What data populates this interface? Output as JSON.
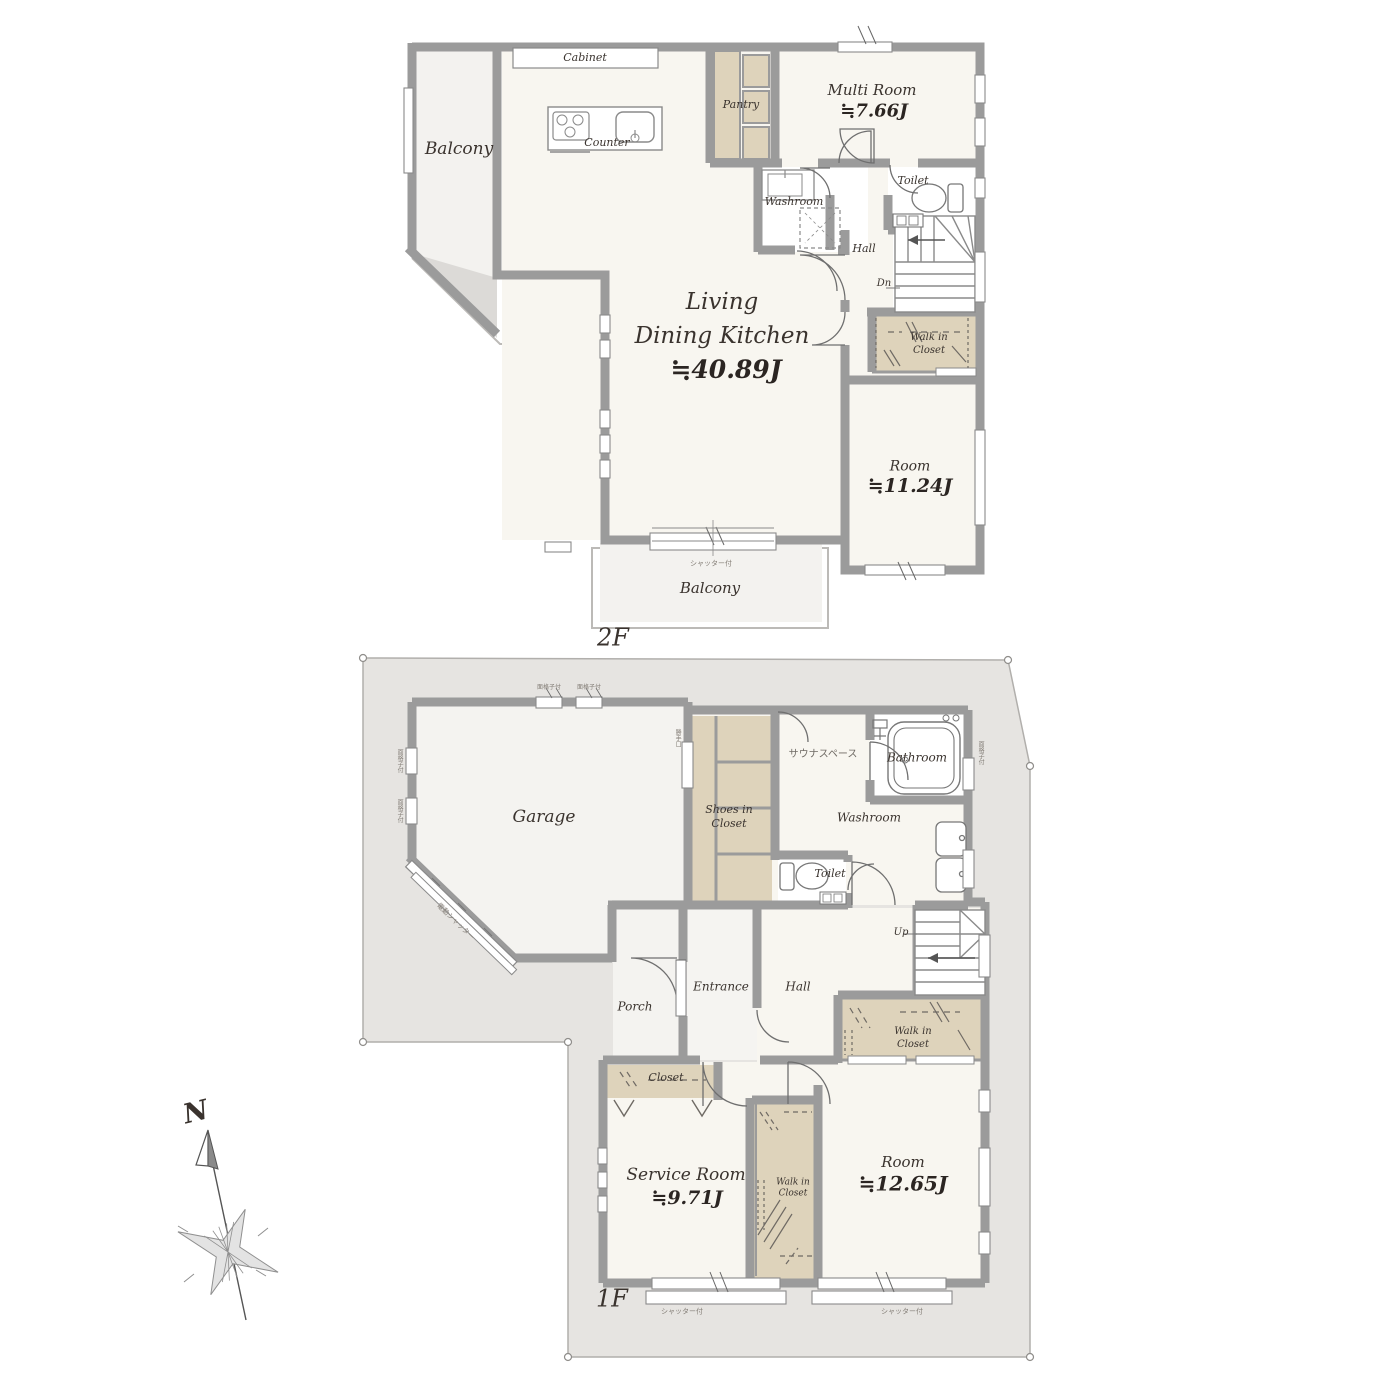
{
  "colors": {
    "wall": "#9b9b9b",
    "room_cream": "#f8f6f0",
    "outdoor": "#f3f2ef",
    "closet_tan": "#ded3bb",
    "lot": "#e6e4e1",
    "text": "#3a332e"
  },
  "floor2": {
    "floor_label": "2F",
    "balcony_top": "Balcony",
    "cabinet": "Cabinet",
    "counter": "Counter",
    "pantry": "Pantry",
    "multi_room": {
      "name": "Multi Room",
      "area": "≒7.66J"
    },
    "washroom": "Washroom",
    "toilet": "Toilet",
    "hall": "Hall",
    "stairs_dn": "Dn",
    "walk_in_closet": {
      "line1": "Walk in",
      "line2": "Closet"
    },
    "ldk": {
      "line1": "Living",
      "line2": "Dining Kitchen",
      "area": "≒40.89J"
    },
    "room": {
      "name": "Room",
      "area": "≒11.24J"
    },
    "balcony_bottom": "Balcony",
    "shutter_note": "シャッター付"
  },
  "floor1": {
    "floor_label": "1F",
    "garage": "Garage",
    "garage_shutter_note": "電動シャッター",
    "grille_note_top1": "面格子付",
    "grille_note_top2": "面格子付",
    "grille_note_left1": "面格子付",
    "grille_note_left2": "面格子付",
    "back_door_note": "勝手口",
    "bath_window_note": "面格子付",
    "shoes_closet": {
      "line1": "Shoes in",
      "line2": "Closet"
    },
    "sauna": "サウナスペース",
    "bathroom": "Bathroom",
    "washroom": "Washroom",
    "toilet": "Toilet",
    "stairs_up": "Up",
    "hall": "Hall",
    "entrance": "Entrance",
    "porch": "Porch",
    "closet": "Closet",
    "walk_in_closet_right": {
      "line1": "Walk in",
      "line2": "Closet"
    },
    "service_room": {
      "name": "Service Room",
      "area": "≒9.71J"
    },
    "walk_in_closet_mid": {
      "line1": "Walk in",
      "line2": "Closet"
    },
    "room": {
      "name": "Room",
      "area": "≒12.65J"
    },
    "shutter_note_left": "シャッター付",
    "shutter_note_right": "シャッター付"
  },
  "compass": {
    "north": "N"
  }
}
